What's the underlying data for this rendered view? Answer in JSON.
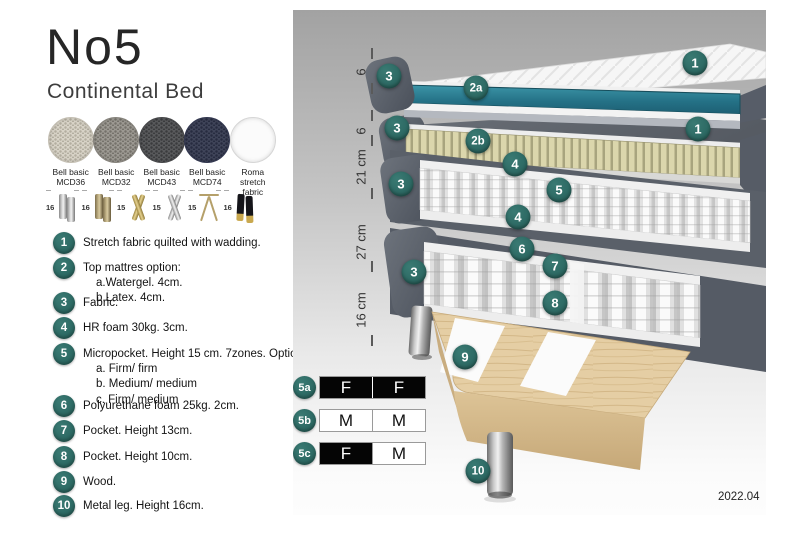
{
  "left_panel": {
    "title": "No5",
    "subtitle": "Continental Bed",
    "fabric_swatches": [
      {
        "name": "Bell basic",
        "code": "MCD36",
        "color": "#d8d3c7",
        "dot": "#b3aea0",
        "border": "#c4bfb3"
      },
      {
        "name": "Bell basic",
        "code": "MCD32",
        "color": "#9c9992",
        "dot": "#75726b",
        "border": "#86837c"
      },
      {
        "name": "Bell basic",
        "code": "MCD43",
        "color": "#595a5c",
        "dot": "#3b3c3e",
        "border": "#48494b"
      },
      {
        "name": "Bell basic",
        "code": "MCD74",
        "color": "#3f4459",
        "dot": "#272c40",
        "border": "#333850"
      },
      {
        "name": "Roma",
        "code": "stretch fabric",
        "color": "#fbfbfb",
        "dot": "",
        "border": "#d6d6d6"
      }
    ],
    "leg_options": [
      {
        "height": "16",
        "style": "cyl-silver"
      },
      {
        "height": "16",
        "style": "cyl-bronze"
      },
      {
        "height": "15",
        "style": "cross-gold"
      },
      {
        "height": "15",
        "style": "cross-silver"
      },
      {
        "height": "15",
        "style": "hairpin"
      },
      {
        "height": "16",
        "style": "tapered-black"
      }
    ],
    "features": [
      {
        "num": "1",
        "lines": [
          "Stretch fabric quilted with wadding."
        ]
      },
      {
        "num": "2",
        "lines": [
          "Top mattres option:",
          "a.Watergel. 4cm.",
          "b.Latex. 4cm."
        ]
      },
      {
        "num": "3",
        "lines": [
          "Fabric."
        ]
      },
      {
        "num": "4",
        "lines": [
          "HR foam 30kg. 3cm."
        ]
      },
      {
        "num": "5",
        "lines": [
          "Micropocket. Height 15 cm. 7zones. Option:",
          "a. Firm/ firm",
          "b. Medium/ medium",
          "c. Firm/ medium"
        ]
      },
      {
        "num": "6",
        "lines": [
          "Polyurethane foam 25kg. 2cm."
        ]
      },
      {
        "num": "7",
        "lines": [
          "Pocket. Height 13cm."
        ]
      },
      {
        "num": "8",
        "lines": [
          "Pocket. Height 10cm."
        ]
      },
      {
        "num": "9",
        "lines": [
          "Wood."
        ]
      },
      {
        "num": "10",
        "lines": [
          "Metal leg. Height 16cm."
        ]
      }
    ]
  },
  "diagram": {
    "ruler_labels": [
      "6",
      "6",
      "21 cm",
      "27 cm",
      "16 cm"
    ],
    "callouts": [
      {
        "label": "3",
        "x": 96,
        "y": 66
      },
      {
        "label": "2a",
        "x": 183,
        "y": 78
      },
      {
        "label": "1",
        "x": 402,
        "y": 53
      },
      {
        "label": "3",
        "x": 104,
        "y": 118
      },
      {
        "label": "2b",
        "x": 185,
        "y": 131
      },
      {
        "label": "1",
        "x": 405,
        "y": 119
      },
      {
        "label": "4",
        "x": 222,
        "y": 154
      },
      {
        "label": "5",
        "x": 266,
        "y": 180
      },
      {
        "label": "3",
        "x": 108,
        "y": 174
      },
      {
        "label": "4",
        "x": 225,
        "y": 207
      },
      {
        "label": "6",
        "x": 229,
        "y": 239
      },
      {
        "label": "7",
        "x": 262,
        "y": 256
      },
      {
        "label": "3",
        "x": 121,
        "y": 262
      },
      {
        "label": "8",
        "x": 262,
        "y": 293
      },
      {
        "label": "9",
        "x": 172,
        "y": 347
      },
      {
        "label": "10",
        "x": 185,
        "y": 461
      }
    ],
    "firmness_rows": [
      {
        "id": "5a",
        "cells": [
          {
            "text": "F",
            "variant": "dark"
          },
          {
            "text": "F",
            "variant": "dark"
          }
        ]
      },
      {
        "id": "5b",
        "cells": [
          {
            "text": "M",
            "variant": "light"
          },
          {
            "text": "M",
            "variant": "light"
          }
        ]
      },
      {
        "id": "5c",
        "cells": [
          {
            "text": "F",
            "variant": "dark"
          },
          {
            "text": "M",
            "variant": "light"
          }
        ]
      }
    ],
    "version": "2022.04"
  },
  "colors": {
    "accent_teal": "#2e6b65",
    "watergel_teal": "#2a7e91",
    "latex_cream": "#d9d4a9",
    "fabric_gray": "#5a6069",
    "wood": "#e5cea4"
  }
}
